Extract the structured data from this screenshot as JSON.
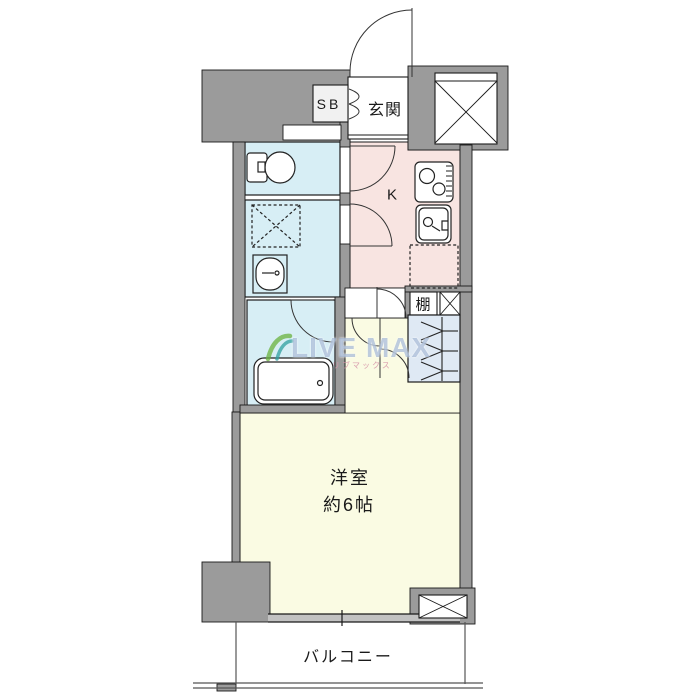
{
  "floorplan": {
    "title": "1K apartment floor plan",
    "labels": {
      "shoe_box": "SB",
      "entrance": "玄関",
      "kitchen": "K",
      "shelf": "棚",
      "room_name": "洋室",
      "room_size": "約6帖",
      "balcony": "バルコニー"
    },
    "watermark": {
      "text": "LIVE MAX",
      "subtext": "リブマックス",
      "text_color": "#88a3c9",
      "logo_colors": [
        "#6ab33e",
        "#2fa0a0"
      ]
    },
    "colors": {
      "wall": "#9b9b9b",
      "wet_area_floor": "#d7eef5",
      "kitchen_floor": "#f8e4e1",
      "main_room_floor": "#fafbe3",
      "closet_floor": "#dfe9f4",
      "outline": "#1a1a1a",
      "background": "#ffffff"
    },
    "icons": {
      "toilet": "toilet-icon",
      "washer_space": "washing-machine-space-icon",
      "washbasin": "washbasin-icon",
      "bathtub": "bathtub-icon",
      "stove": "gas-stove-icon",
      "kitchen_sink": "kitchen-sink-icon",
      "refrigerator_space": "refrigerator-space-icon",
      "hanger_pipe": "closet-hanger-icon",
      "elevator_shaft": "elevator-x-box-icon",
      "pipe_space": "pipe-space-x-box-icon",
      "shelf_x_box": "shelf-x-box-icon",
      "door_swing": "door-swing-arc-icon"
    }
  }
}
